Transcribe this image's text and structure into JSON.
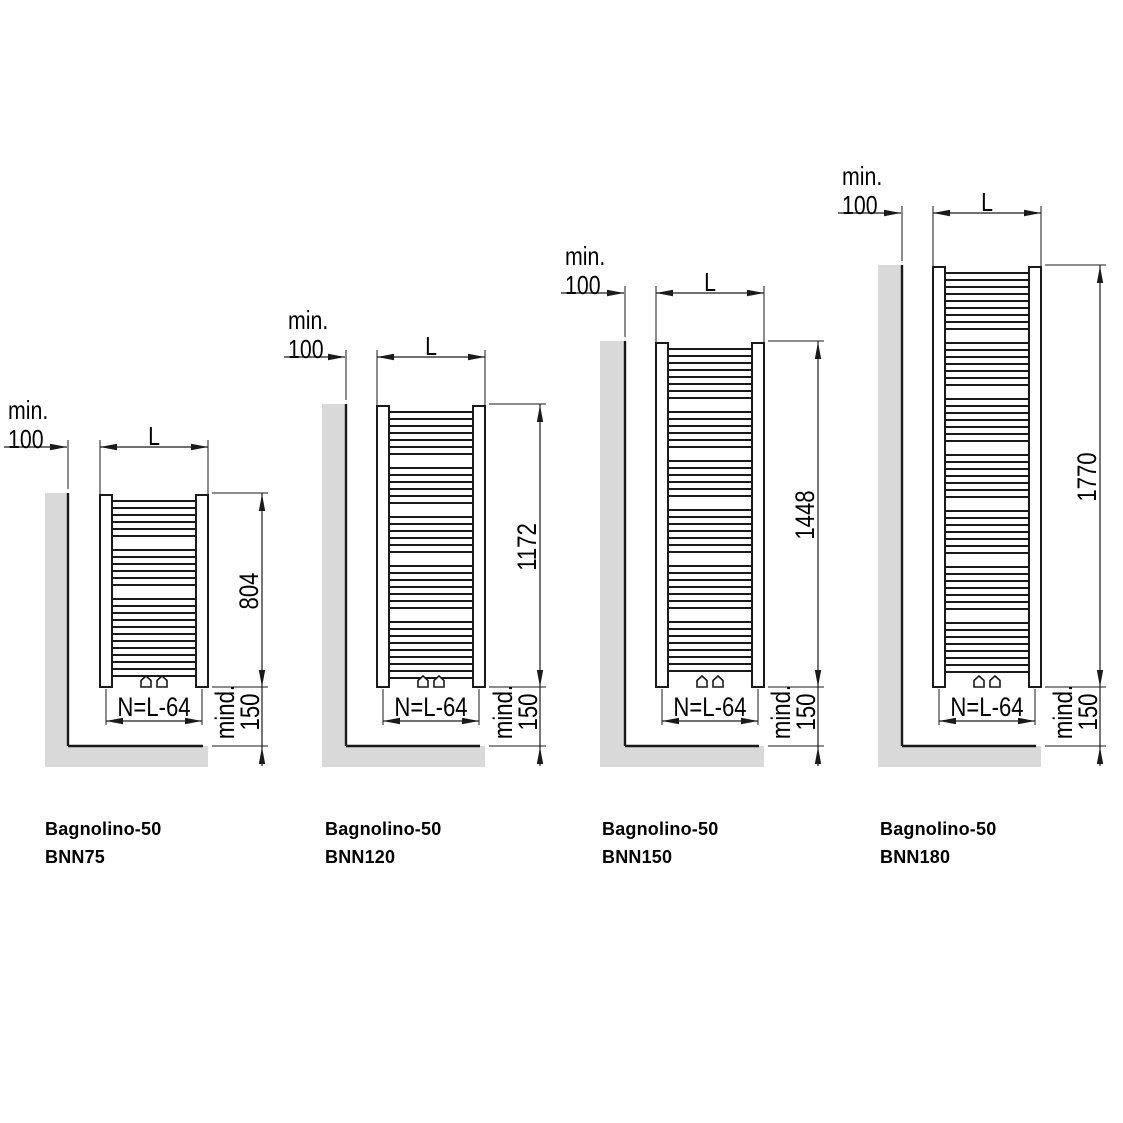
{
  "colors": {
    "line": "#1a1a1a",
    "dim_line": "#1a1a1a",
    "wall_fill": "#d9d9d9",
    "radiator_fill": "#ffffff",
    "background": "#ffffff",
    "text": "#000000"
  },
  "shared_labels": {
    "min_line1": "min.",
    "min_line2": "100",
    "width": "L",
    "bottom_width": "N=L-64",
    "floor_min_line1": "mind.",
    "floor_min_line2": "150"
  },
  "diagrams": [
    {
      "series": "Bagnolino-50",
      "model": "BNN75",
      "overall_height": "804",
      "geom": {
        "wall_x": 68,
        "gray_left": 45,
        "rad_left": 100,
        "rad_right": 208,
        "top": 495,
        "dim_y": 447,
        "dim_x": 262,
        "min_text_x": 8,
        "label_x": 45,
        "rung_groups": [
          6,
          6,
          12
        ]
      }
    },
    {
      "series": "Bagnolino-50",
      "model": "BNN120",
      "overall_height": "1172",
      "geom": {
        "wall_x": 346,
        "gray_left": 322,
        "rad_left": 377,
        "rad_right": 485,
        "top": 406,
        "dim_y": 357,
        "dim_x": 540,
        "min_text_x": 288,
        "label_x": 325,
        "rung_groups": [
          7,
          6,
          6,
          7,
          9
        ]
      }
    },
    {
      "series": "Bagnolino-50",
      "model": "BNN150",
      "overall_height": "1448",
      "geom": {
        "wall_x": 625,
        "gray_left": 600,
        "rad_left": 656,
        "rad_right": 764,
        "top": 343,
        "dim_y": 293,
        "dim_x": 818,
        "min_text_x": 565,
        "label_x": 602,
        "rung_groups": [
          8,
          6,
          6,
          7,
          7,
          8
        ]
      }
    },
    {
      "series": "Bagnolino-50",
      "model": "BNN180",
      "overall_height": "1770",
      "geom": {
        "wall_x": 902,
        "gray_left": 878,
        "rad_left": 933,
        "rad_right": 1041,
        "top": 267,
        "dim_y": 213,
        "dim_x": 1100,
        "min_text_x": 842,
        "label_x": 880,
        "rung_groups": [
          9,
          7,
          7,
          7,
          7,
          7,
          8
        ]
      }
    }
  ],
  "shared_geom": {
    "bottom": 687,
    "floor": 746,
    "gray_bottom": 767,
    "bar_width": 12,
    "rung_pitch": 7,
    "group_gap": 14,
    "rung_start_offset": 6,
    "n_dim_y": 721,
    "n_text_y": 693,
    "label_y1": 820,
    "label_y2": 848,
    "mind_text_y": 712
  }
}
